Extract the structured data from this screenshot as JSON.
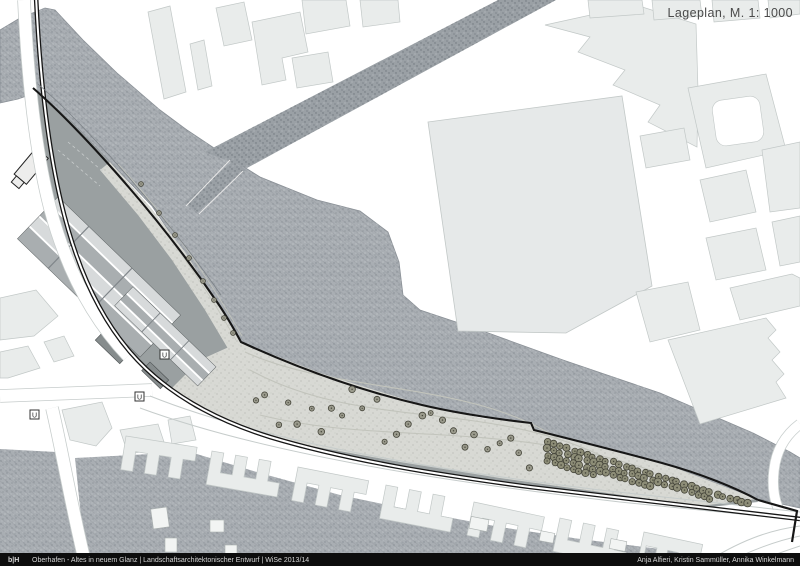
{
  "header": {
    "title": "Lageplan, M. 1: 1000"
  },
  "footer": {
    "logo": "b|H",
    "project_line": "Oberhafen - Altes in neuem Glanz | Landschaftsarchitektonischer Entwurf | WiSe 2013/14",
    "authors": "Anja Alfieri, Kristin Sammüller, Annika Winkelmann"
  },
  "map": {
    "ubahn_label": "U",
    "colors": {
      "water": "#a9aeb3",
      "water_grain": "#878d93",
      "water_grain_lt": "#c6cacd",
      "bank_line": "#8a9096",
      "building": "#e9eceb",
      "building_big": "#e6e9e9",
      "building_outline": "#c2c8c7",
      "ground": "#9aa0a1",
      "promenade": "#d8d9d4",
      "promenade_dot": "#b2b4ac",
      "road_stipple": "#9aa0a5",
      "road_stipple_dot": "#70767c",
      "road_edge": "#c6cccb",
      "path_line": "#c2c4bc",
      "rail": "#161616",
      "tree": "#9a9a8c",
      "tree_dense": "#8d8d77",
      "tree_dark": "#45453a",
      "hall_light": "#d7dadb",
      "hall_mid": "#bcc1c2",
      "hall_dark": "#a9aeb0",
      "footer_bg": "#0d0d0d",
      "footer_text": "#d6d6d6",
      "title_text": "#4a4a4a"
    }
  }
}
